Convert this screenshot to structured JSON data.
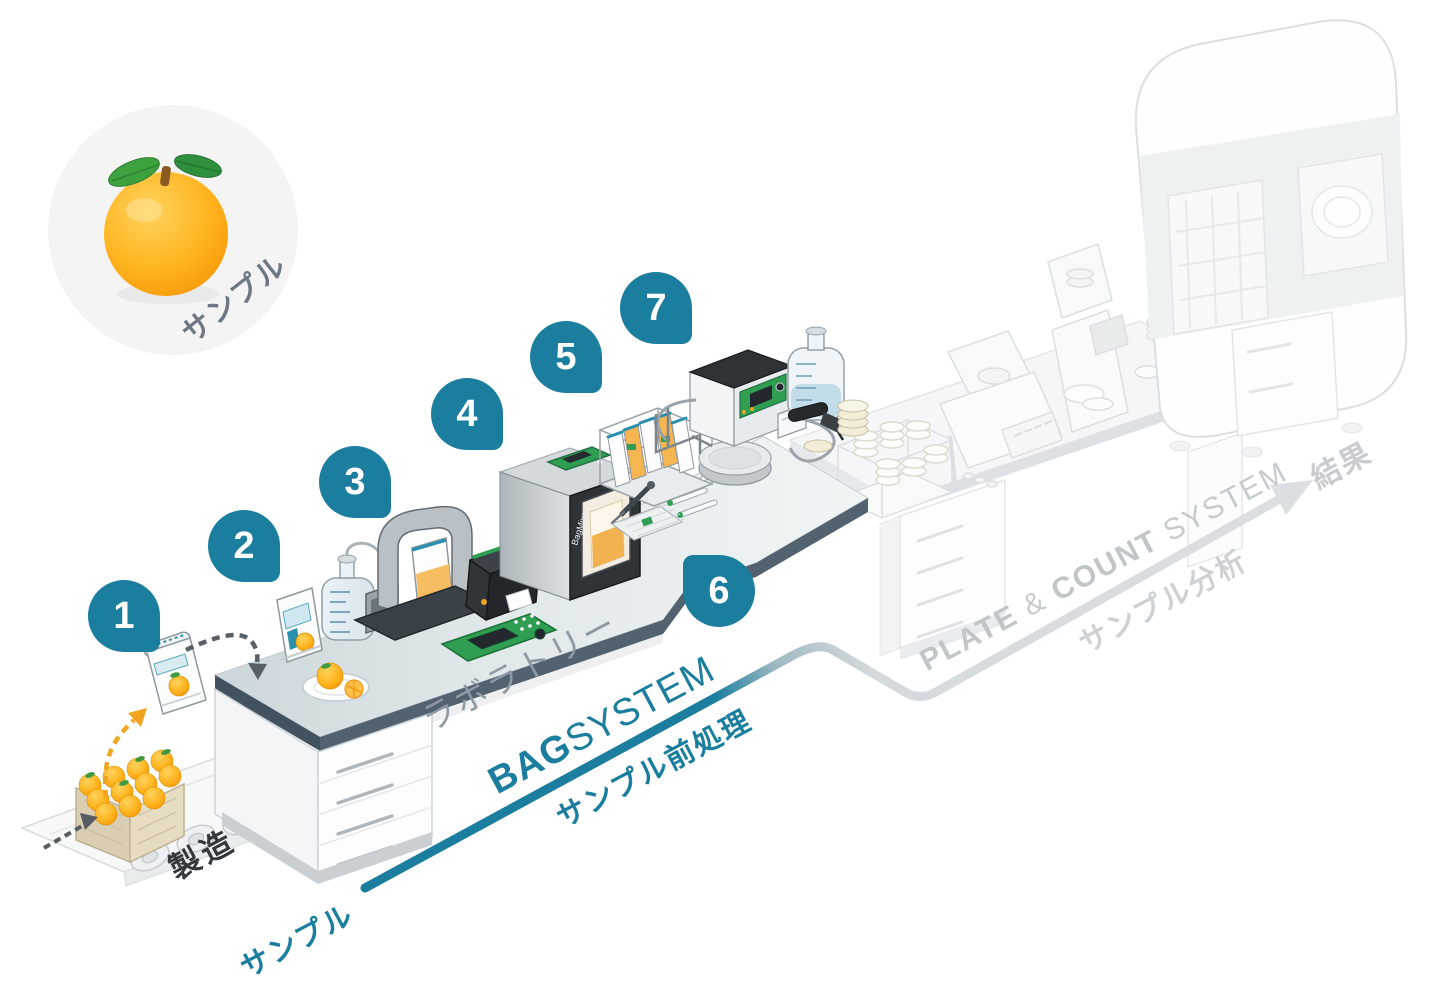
{
  "sample_circle": {
    "label": "サンプル"
  },
  "process": {
    "manufacturing": "製造",
    "laboratory": "ラボラトリー",
    "sample_in": "サンプル",
    "bag_bold": "BAG",
    "bag_rest": "SYSTEM",
    "pretreatment": "サンプル前処理",
    "plate": "PLATE",
    "ampersand": "&",
    "count": "COUNT",
    "system": "SYSTEM",
    "analysis": "サンプル分析",
    "result": "結果"
  },
  "badges": [
    "1",
    "2",
    "3",
    "4",
    "5",
    "6",
    "7"
  ],
  "equipment": {
    "bagmixer": "BagMixer"
  },
  "colors": {
    "teal": "#1b7e9e",
    "flow_gray": "#dcdfe1",
    "gray_text": "#c6cbce",
    "muted_text": "#8d99a3",
    "dark_text": "#33383c",
    "orange": "#f5a623",
    "green": "#2f9e53"
  }
}
